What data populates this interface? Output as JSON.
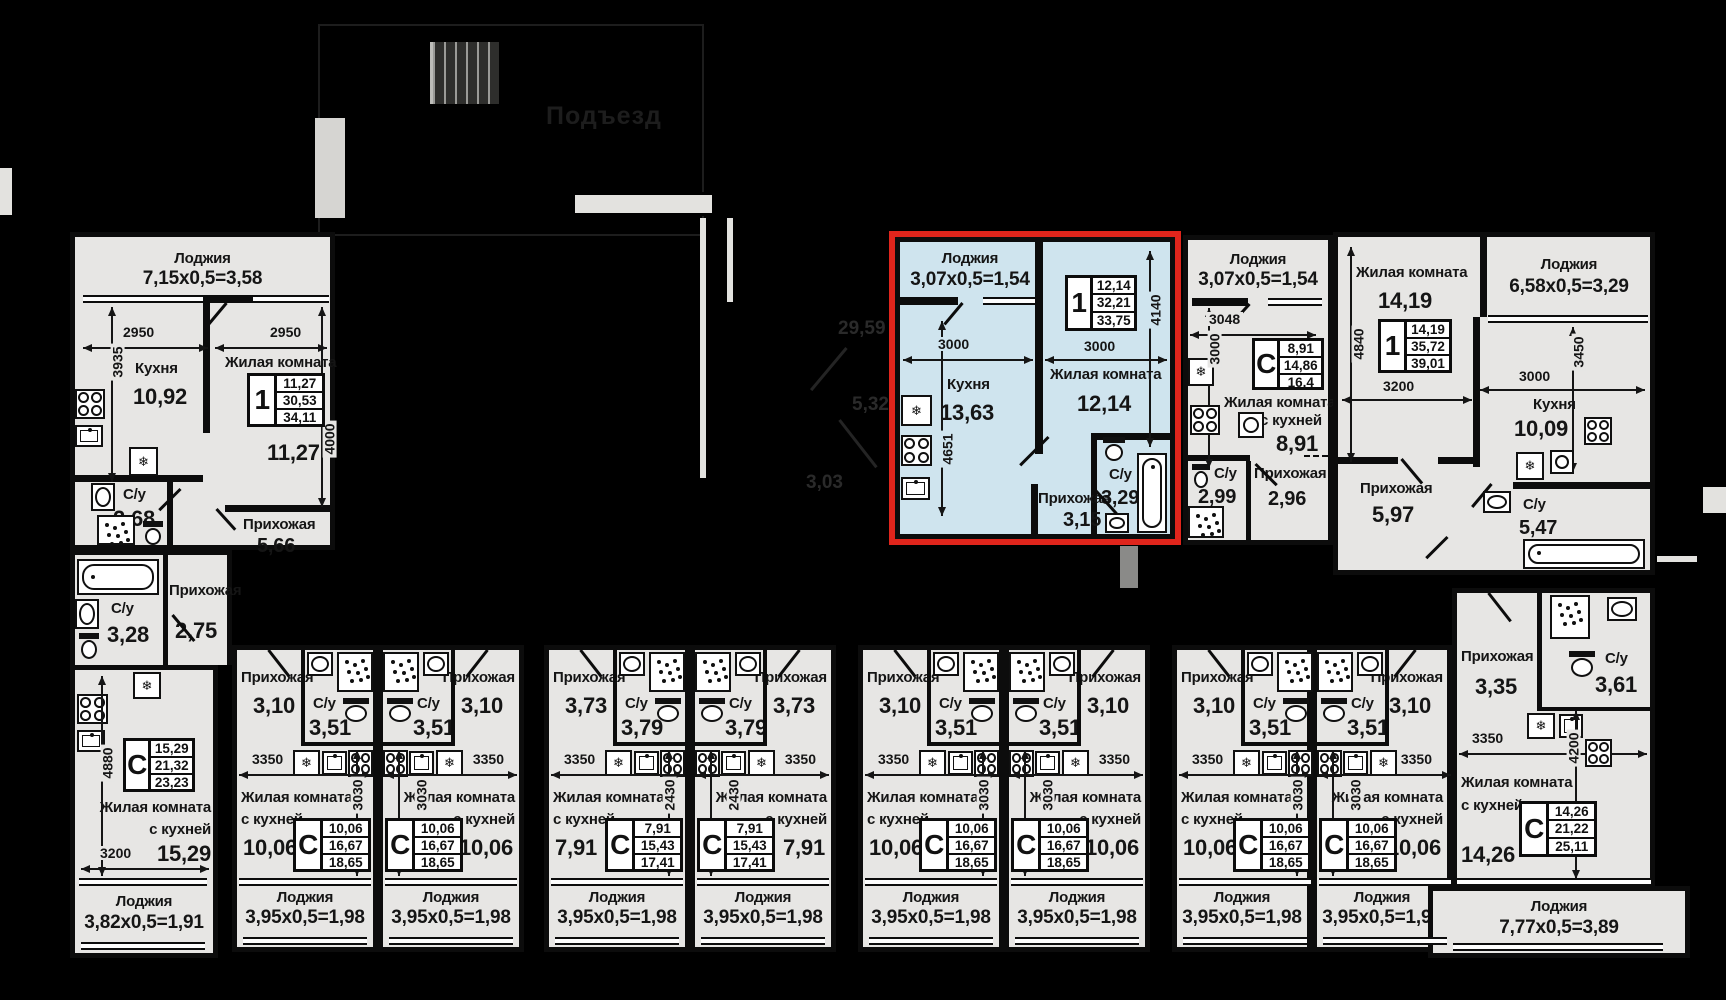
{
  "site": {
    "entrance": "Подъезд",
    "faint_dims": {
      "d1": "29,59",
      "d2": "5,32",
      "d3": "3,03"
    }
  },
  "colors": {
    "background": "#000000",
    "floor": "#e7e6e4",
    "highlight_floor": "#cfe4ee",
    "highlight_border": "#e0251c",
    "wall": "#0c0c0c"
  },
  "labels": {
    "loggia": "Лоджия",
    "kitchen": "Кухня",
    "living": "Жилая комната",
    "with_kitchen": "с кухней",
    "hall": "Прихожая",
    "bath": "С/у"
  },
  "apartments": {
    "a1": {
      "loggia": "7,15х0,5=3,58",
      "kitchen": "10,92",
      "living": "11,27",
      "bath": "2,68",
      "hall": "5,66",
      "info": {
        "tag": "1",
        "v1": "11,27",
        "v2": "30,53",
        "v3": "34,11"
      },
      "dims": {
        "w1": "2950",
        "w2": "2950",
        "h1": "3935",
        "h2": "4000"
      }
    },
    "a2": {
      "bath": "3,28",
      "hall": "2,75",
      "room": "15,29",
      "loggia": "3,82х0,5=1,91",
      "info": {
        "tag": "С",
        "v1": "15,29",
        "v2": "21,32",
        "v3": "23,23"
      },
      "dims": {
        "h": "4880",
        "w": "3200"
      }
    },
    "a3": {
      "loggia": "3,07х0,5=1,54",
      "kitchen": "13,63",
      "living": "12,14",
      "bath": "3,29",
      "hall": "3,15",
      "info": {
        "tag": "1",
        "v1": "12,14",
        "v2": "32,21",
        "v3": "33,75"
      },
      "dims": {
        "w1": "3000",
        "h1": "4651",
        "w2": "3000",
        "h2": "4140"
      }
    },
    "a4": {
      "loggia": "3,07х0,5=1,54",
      "room": "8,91",
      "bath": "2,99",
      "hall": "2,96",
      "info": {
        "tag": "С",
        "v1": "8,91",
        "v2": "14,86",
        "v3": "16,4"
      },
      "dims": {
        "w": "3048",
        "h": "3000"
      }
    },
    "a5": {
      "living": "14,19",
      "kitchen": "10,09",
      "bath": "5,47",
      "hall": "5,97",
      "loggia": "6,58х0,5=3,29",
      "info": {
        "tag": "1",
        "v1": "14,19",
        "v2": "35,72",
        "v3": "39,01"
      },
      "dims": {
        "h1": "4840",
        "w1": "3200",
        "w2": "3000",
        "h2": "3450"
      }
    },
    "sA": {
      "hall": "3,10",
      "bath": "3,51",
      "room": "10,06",
      "loggia": "3,95х0,5=1,98",
      "info": {
        "tag": "С",
        "v1": "10,06",
        "v2": "16,67",
        "v3": "18,65"
      },
      "dims": {
        "w": "3350",
        "h": "3030"
      }
    },
    "sB": {
      "hall": "3,73",
      "bath": "3,79",
      "room": "7,91",
      "loggia": "3,95х0,5=1,98",
      "info": {
        "tag": "С",
        "v1": "7,91",
        "v2": "15,43",
        "v3": "17,41"
      },
      "dims": {
        "w": "3350",
        "h": "2430"
      }
    },
    "s9": {
      "hall": "3,35",
      "bath": "3,61",
      "room": "14,26",
      "loggia": "7,77х0,5=3,89",
      "info": {
        "tag": "С",
        "v1": "14,26",
        "v2": "21,22",
        "v3": "25,11"
      },
      "dims": {
        "w": "3350",
        "h": "4200"
      }
    }
  }
}
